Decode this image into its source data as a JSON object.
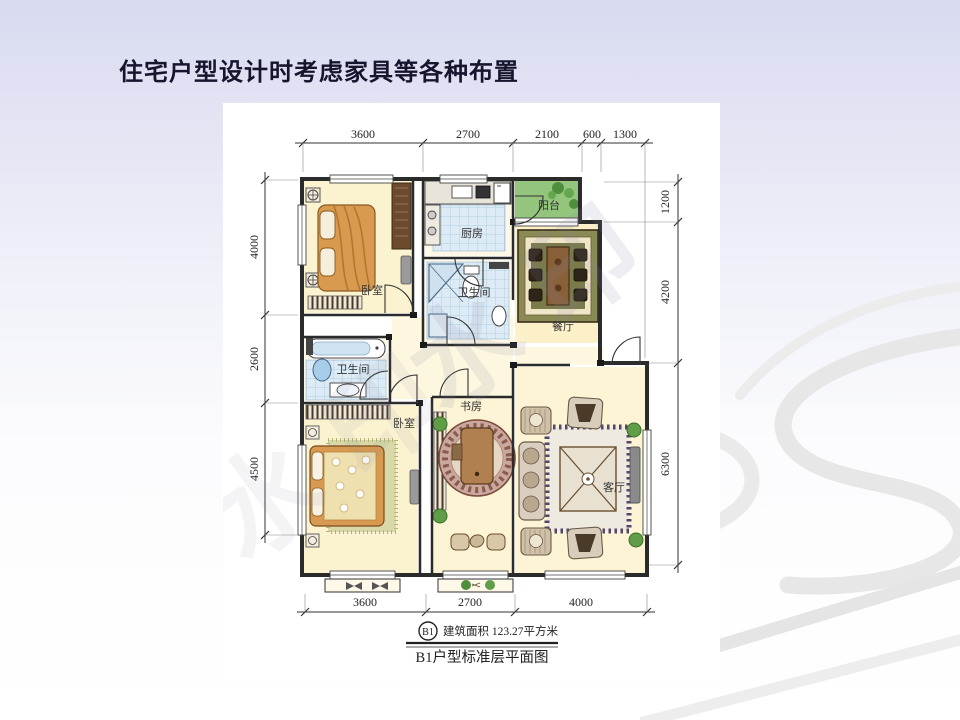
{
  "slide": {
    "title": "住宅户型设计时考虑家具等各种布置"
  },
  "floorplan": {
    "dims": {
      "top": [
        "3600",
        "2700",
        "2100",
        "600",
        "1300"
      ],
      "left": [
        "4000",
        "2600",
        "4500"
      ],
      "right": [
        "1200",
        "4200",
        "6300"
      ],
      "bottom": [
        "3600",
        "2700",
        "4000"
      ]
    },
    "rooms": {
      "bedroom1": "卧室",
      "kitchen": "厨房",
      "balcony": "阳台",
      "bath1": "卫生间",
      "dining": "餐厅",
      "bath2": "卫生间",
      "bedroom2": "卧室",
      "study": "书房",
      "living": "客厅"
    },
    "legend": {
      "unit_badge": "B1",
      "area_text": "建筑面积 123.27平方米",
      "caption": "B1户型标准层平面图"
    },
    "watermark": "水印"
  },
  "colors": {
    "background_top": "#d8daf0",
    "background_bottom": "#ffffff",
    "title_text": "#15152e",
    "plan_ink": "#2b2b2b",
    "room_warm": "#fbf2cf",
    "tile_blue": "#dcebf5",
    "balcony_green": "#94c57c",
    "wood_orange": "#d79a4f",
    "dark_wood": "#3f2f1f",
    "watermark_gray": "#8888a0"
  }
}
